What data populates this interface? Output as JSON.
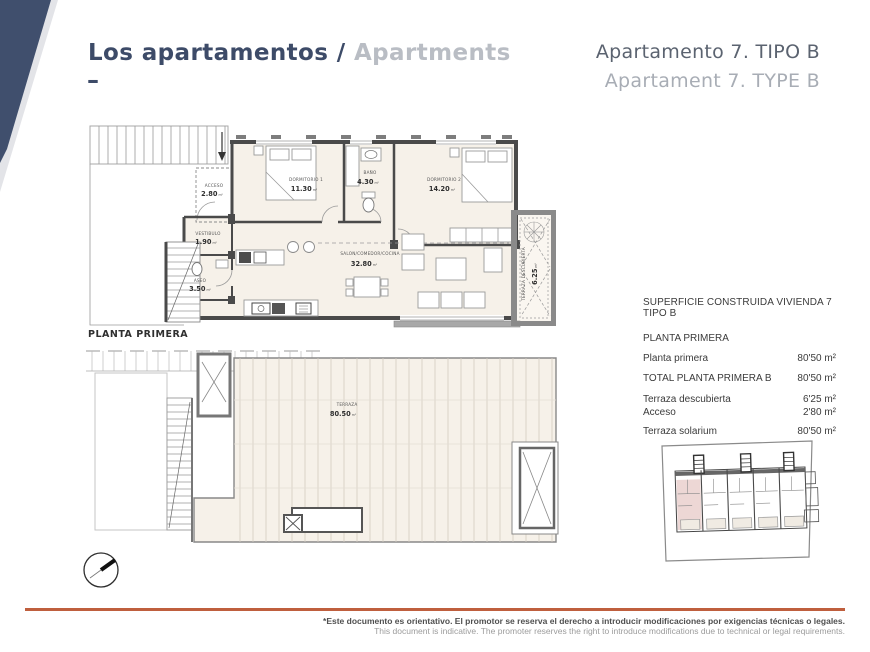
{
  "header": {
    "title_es": "Los apartamentos",
    "title_sep": " / ",
    "title_en": "Apartments",
    "dash": "–",
    "unit_line1": "Apartamento 7. TIPO B",
    "unit_line2": "Apartament 7. TYPE B"
  },
  "plan_upper": {
    "caption": "PLANTA PRIMERA",
    "rooms": {
      "acceso": {
        "label": "ACCESO",
        "area": "2.80",
        "unit": "m²"
      },
      "dormitorio1": {
        "label": "DORMITORIO 1",
        "area": "11.30",
        "unit": "m²"
      },
      "bano": {
        "label": "BAÑO",
        "area": "4.30",
        "unit": "m²"
      },
      "dormitorio2": {
        "label": "DORMITORIO 2",
        "area": "14.20",
        "unit": "m²"
      },
      "vestibulo": {
        "label": "VESTIBULO",
        "area": "1.90",
        "unit": "m²"
      },
      "aseo": {
        "label": "ASEO",
        "area": "3.50",
        "unit": "m²"
      },
      "salon": {
        "label": "SALON/COMEDOR/COCINA",
        "area": "32.80",
        "unit": "m²"
      },
      "terraza_desc": {
        "label": "TERRAZA DESCUBIERTA",
        "area": "6.25",
        "unit": "m²"
      }
    }
  },
  "plan_lower": {
    "rooms": {
      "terraza": {
        "label": "TERRAZA",
        "area": "80.50",
        "unit": "m²"
      }
    }
  },
  "surface_table": {
    "title": "SUPERFICIE CONSTRUIDA VIVIENDA 7 TIPO B",
    "section": "PLANTA PRIMERA",
    "rows": [
      {
        "label": "Planta primera",
        "value": "80'50 m²"
      },
      {
        "label": "TOTAL PLANTA PRIMERA B",
        "value": "80'50 m²"
      },
      {
        "label": "Terraza descubierta",
        "value": "6'25 m²"
      },
      {
        "label": "Acceso",
        "value": "2'80 m²"
      },
      {
        "label": "Terraza solarium",
        "value": "80'50 m²"
      }
    ]
  },
  "footer": {
    "disclaimer_es": "*Este documento es orientativo. El promotor se reserva el derecho a introducir modificaciones por exigencias técnicas o legales.",
    "disclaimer_en": "This document is indicative. The promoter reserves the right to introduce modifications due to technical or legal requirements."
  },
  "colors": {
    "accent_navy": "#404f6d",
    "accent_orange": "#bf5f3e",
    "highlight_unit": "#edd7d5"
  }
}
